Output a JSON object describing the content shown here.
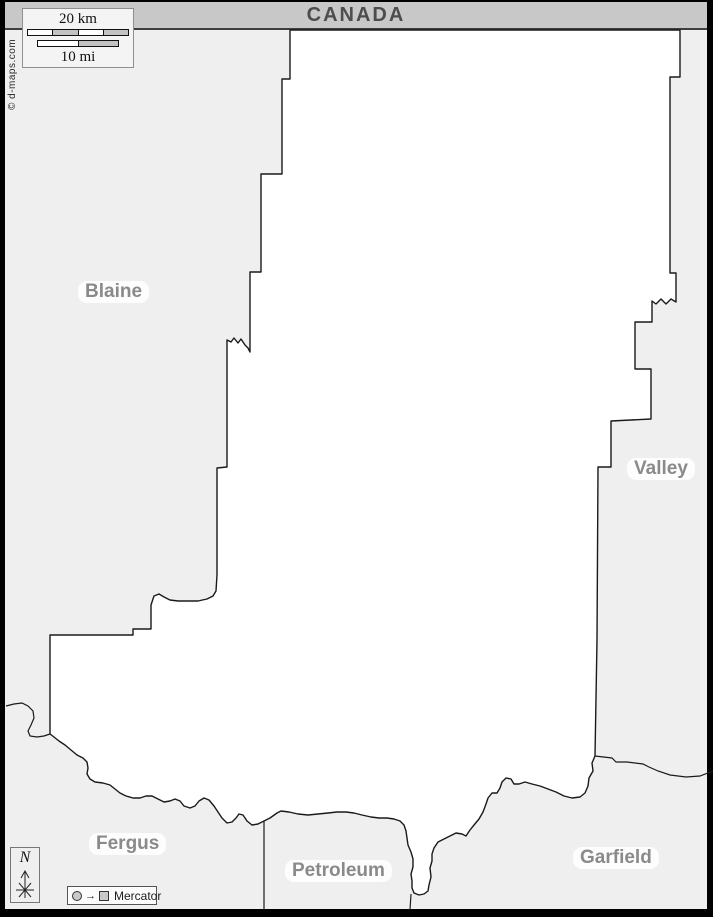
{
  "banner": {
    "title": "CANADA"
  },
  "scale_box": {
    "km_label": "20 km",
    "mi_label": "10 mi"
  },
  "copyright": "© d-maps.com",
  "compass": {
    "north_label": "N"
  },
  "legend": {
    "arrow_glyph": "→",
    "projection_label": "Mercator"
  },
  "map": {
    "labels": [
      {
        "id": "blaine",
        "text": "Blaine"
      },
      {
        "id": "valley",
        "text": "Valley"
      },
      {
        "id": "fergus",
        "text": "Fergus"
      },
      {
        "id": "petroleum",
        "text": "Petroleum"
      },
      {
        "id": "garfield",
        "text": "Garfield"
      }
    ],
    "colors": {
      "frame": "#000000",
      "banner_bg": "#c8c8c8",
      "banner_text": "#4d4d4d",
      "map_bg": "#efefef",
      "county_fill": "#ffffff",
      "boundary": "#1a1a1a",
      "label_text": "#8a8a8a"
    }
  }
}
